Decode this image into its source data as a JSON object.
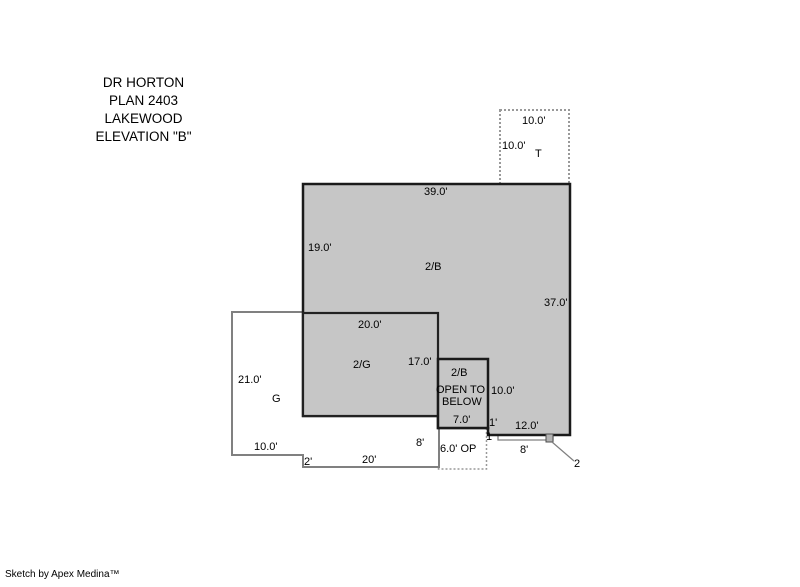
{
  "colors": {
    "area_fill": "#c6c6c6",
    "bold_line": "#1a1a1a",
    "thin_line": "#808080",
    "dashed_line": "#999999",
    "text": "#000000",
    "background": "#ffffff"
  },
  "title": {
    "lines": [
      "DR HORTON",
      "PLAN 2403",
      "LAKEWOOD",
      "ELEVATION \"B\""
    ]
  },
  "tub_box": {
    "label": "T",
    "top_dim": "10.0'",
    "left_dim": "10.0'"
  },
  "upper_floor": {
    "label": "2/B",
    "top_dim": "39.0'",
    "left_dim": "19.0'",
    "right_dim": "37.0'"
  },
  "garage_upper": {
    "label": "2/G",
    "top_dim": "20.0'",
    "right_dim": "17.0'"
  },
  "garage": {
    "label": "G",
    "left_dim": "21.0'",
    "bottom_left_dim": "10.0'",
    "step_dim": "2'",
    "bottom_dim": "20'",
    "right_dim": "8'"
  },
  "open_to_below": {
    "label_line1": "2/B",
    "label_line2": "OPEN TO",
    "label_line3": "BELOW",
    "bottom_dim": "7.0'",
    "right_dim": "10.0'"
  },
  "open_porch": {
    "label": "6.0' OP"
  },
  "entry_detail": {
    "step_down_dim": "1'",
    "step_depth_dim": "1",
    "bottom_dim": "12.0'",
    "porch_width_dim": "8'",
    "marker": "2"
  },
  "footer": {
    "credit": "Sketch by Apex Medina™"
  }
}
